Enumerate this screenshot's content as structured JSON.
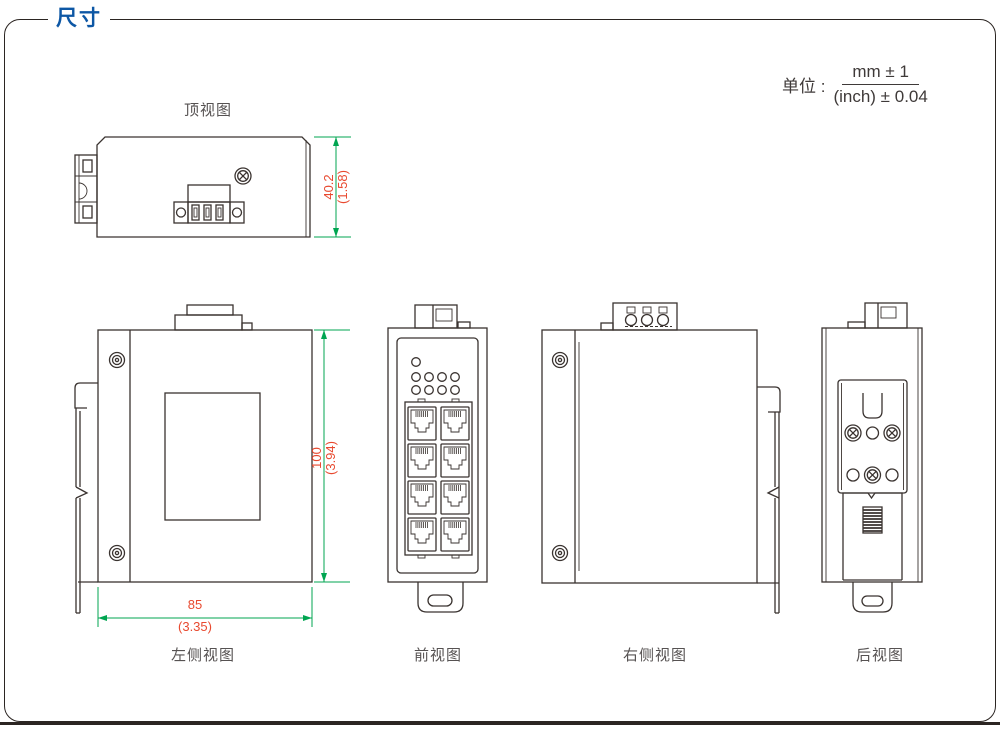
{
  "title": "尺寸",
  "unit": {
    "label": "单位 :",
    "numerator": "mm ± 1",
    "denominator": "(inch) ± 0.04"
  },
  "views": {
    "top": {
      "label": "顶视图",
      "dim_height": {
        "mm": "40.2",
        "inch": "(1.58)"
      }
    },
    "left": {
      "label": "左侧视图",
      "dim_height": {
        "mm": "100",
        "inch": "(3.94)"
      },
      "dim_width": {
        "mm": "85",
        "inch": "(3.35)"
      }
    },
    "front": {
      "label": "前视图",
      "led_count": 9,
      "rj45_port_count": 8
    },
    "right": {
      "label": "右侧视图"
    },
    "back": {
      "label": "后视图"
    }
  },
  "colors": {
    "title_blue": "#0d57a5",
    "dimension_line_green": "#00a551",
    "dimension_text_red": "#e8492f",
    "drawing_line_dark": "#3a3330",
    "frame_border": "#2b2522"
  }
}
